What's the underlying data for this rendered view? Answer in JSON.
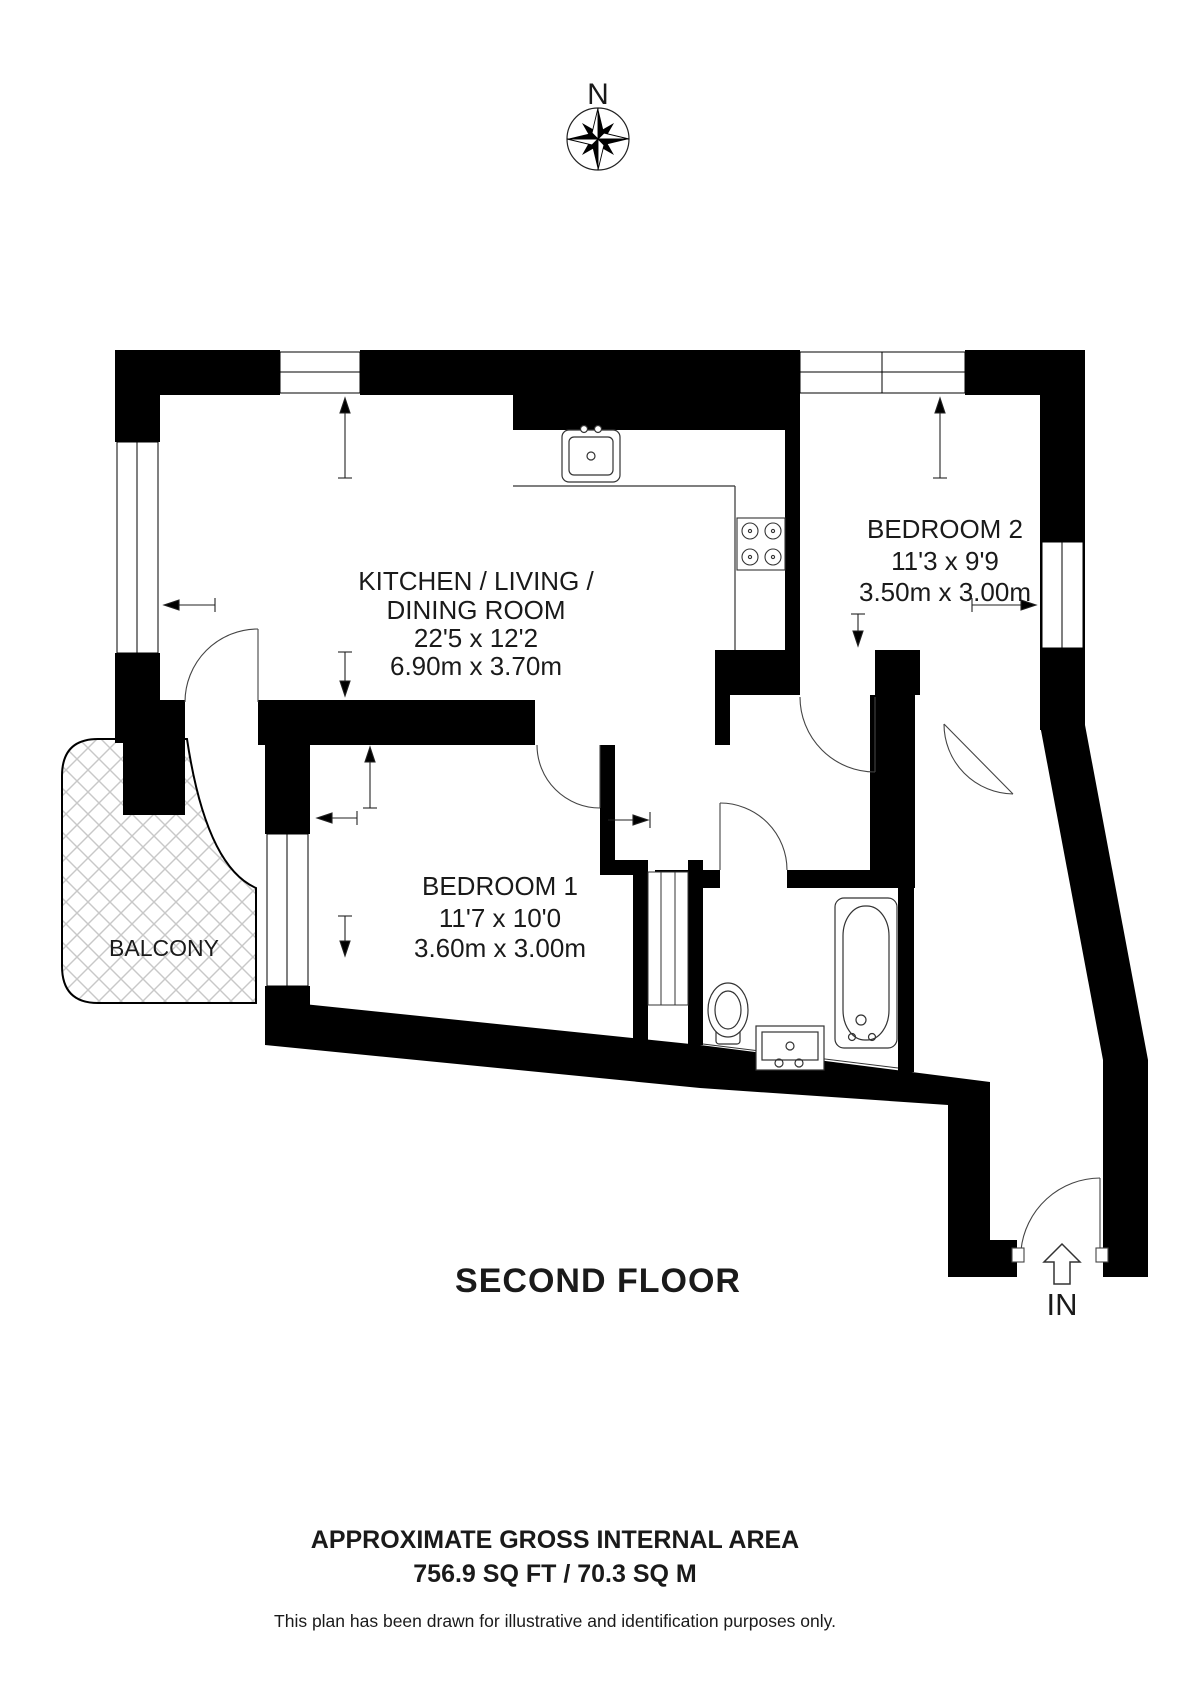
{
  "compass": {
    "north_label": "N"
  },
  "rooms": {
    "kitchen": {
      "name_line1": "KITCHEN / LIVING /",
      "name_line2": "DINING ROOM",
      "dims_ft": "22'5 x 12'2",
      "dims_m": "6.90m x 3.70m"
    },
    "bedroom2": {
      "name": "BEDROOM 2",
      "dims_ft": "11'3 x 9'9",
      "dims_m": "3.50m x 3.00m"
    },
    "bedroom1": {
      "name": "BEDROOM 1",
      "dims_ft": "11'7 x 10'0",
      "dims_m": "3.60m x 3.00m"
    },
    "balcony": {
      "name": "BALCONY"
    }
  },
  "floor_label": "SECOND FLOOR",
  "entrance": {
    "label": "IN"
  },
  "footer": {
    "area_title": "APPROXIMATE GROSS INTERNAL AREA",
    "area_value": "756.9 SQ FT / 70.3 SQ M",
    "disclaimer": "This plan has been drawn for illustrative and identification purposes only."
  },
  "colors": {
    "wall": "#000000",
    "hatch": "#c8c8c8",
    "background": "#ffffff"
  }
}
